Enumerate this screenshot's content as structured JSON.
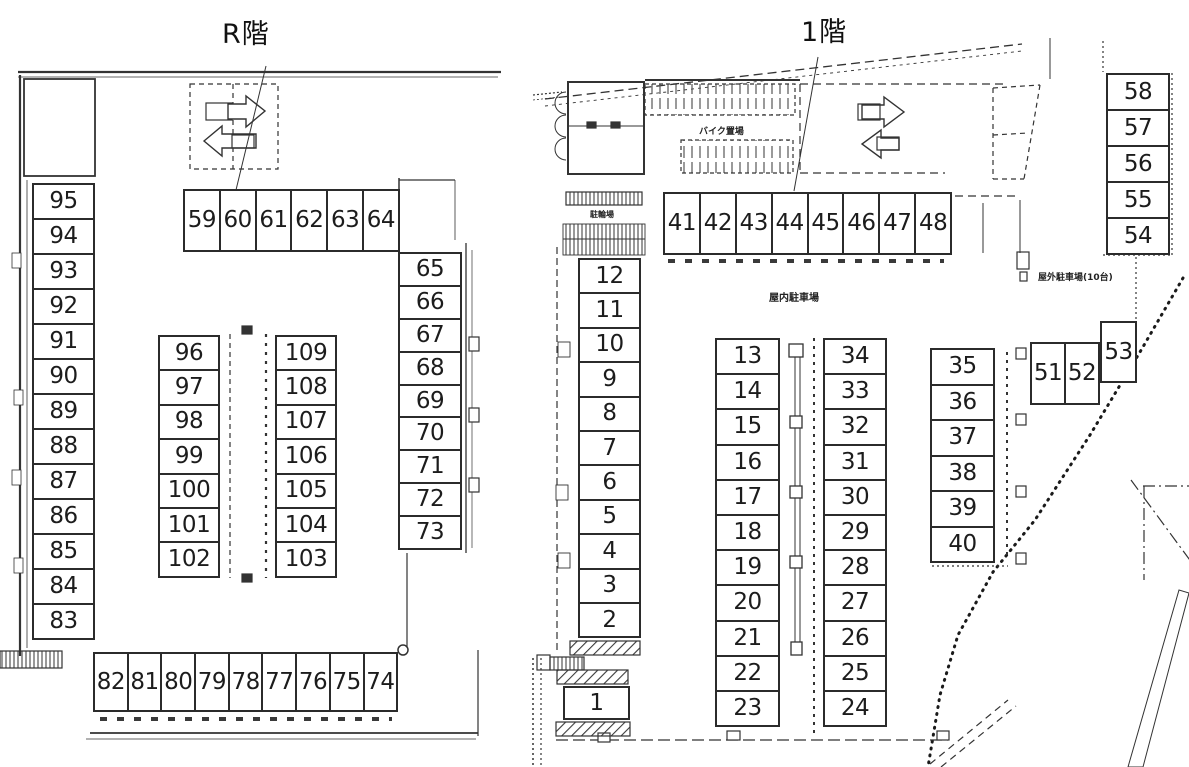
{
  "r_floor": {
    "title": "R階",
    "stalls": {
      "top_row": [
        "59",
        "60",
        "61",
        "62",
        "63",
        "64"
      ],
      "left_col": [
        "95",
        "94",
        "93",
        "92",
        "91",
        "90",
        "89",
        "88",
        "87",
        "86",
        "85",
        "84",
        "83"
      ],
      "mid_left_col": [
        "96",
        "97",
        "98",
        "99",
        "100",
        "101",
        "102"
      ],
      "mid_right_col": [
        "109",
        "108",
        "107",
        "106",
        "105",
        "104",
        "103"
      ],
      "right_col": [
        "65",
        "66",
        "67",
        "68",
        "69",
        "70",
        "71",
        "72",
        "73"
      ],
      "bottom_row": [
        "82",
        "81",
        "80",
        "79",
        "78",
        "77",
        "76",
        "75",
        "74"
      ]
    }
  },
  "first_floor": {
    "title": "1階",
    "labels": {
      "bicycle_parking": "駐輪場",
      "bike_parking": "バイク置場",
      "indoor_parking": "屋内駐車場",
      "outdoor_parking": "屋外駐車場(10台)"
    },
    "stalls": {
      "top_row": [
        "41",
        "42",
        "43",
        "44",
        "45",
        "46",
        "47",
        "48"
      ],
      "left_col": [
        "12",
        "11",
        "10",
        "9",
        "8",
        "7",
        "6",
        "5",
        "4",
        "3",
        "2"
      ],
      "stall_1": "1",
      "mid_left_col": [
        "13",
        "14",
        "15",
        "16",
        "17",
        "18",
        "19",
        "20",
        "21",
        "22",
        "23"
      ],
      "mid_right_col": [
        "34",
        "33",
        "32",
        "31",
        "30",
        "29",
        "28",
        "27",
        "26",
        "25",
        "24"
      ],
      "right_col": [
        "35",
        "36",
        "37",
        "38",
        "39",
        "40"
      ],
      "pair_row": [
        "51",
        "52"
      ],
      "stall_53": "53",
      "far_right_col": [
        "58",
        "57",
        "56",
        "55",
        "54"
      ]
    }
  },
  "colors": {
    "line": "#2b2b2b",
    "background": "#ffffff"
  }
}
